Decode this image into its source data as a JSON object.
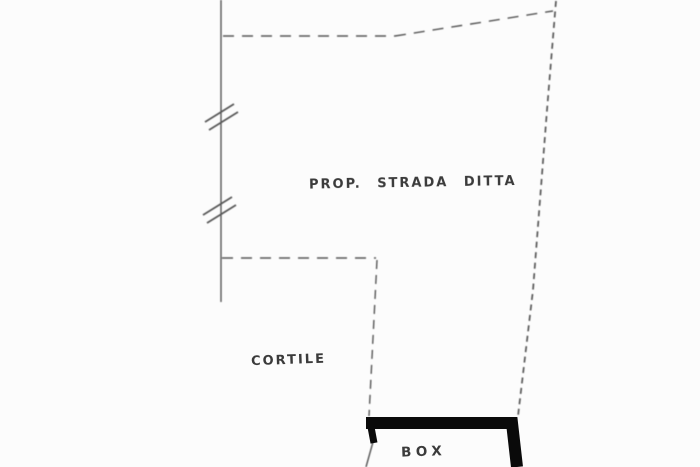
{
  "canvas": {
    "width": 700,
    "height": 467,
    "background": "#fcfcfc",
    "line_color": "#565656",
    "heavy_line_color": "#0a0a0a",
    "text_color": "#3b3b3b"
  },
  "plan": {
    "type": "cadastral-site-plan-sketch",
    "labels": {
      "street": "PROP. STRADA DITTA",
      "courtyard": "CORTILE",
      "garage": "BOX"
    },
    "geometry": {
      "left_boundary": "M221,0 L221,302",
      "break_marks": "M205,122 L234,104 M209,130 L238,112 M203,215 L232,197 M207,223 L236,205",
      "top_boundary": "M223,36 L395,36",
      "top_boundary_angled": "M395,36 L553,11",
      "right_boundary": "M556,1 L547,110 L533,290 L518,416",
      "step_horizontal": "M222,258 L376,258",
      "courtyard_right": "M377,260 L369,416",
      "garage_heavy_wall": "M366,423 L512,423 L517,467",
      "garage_left_stub": "M371,427 L374,443",
      "garage_left_wall": "M373,442 L366,467"
    }
  }
}
